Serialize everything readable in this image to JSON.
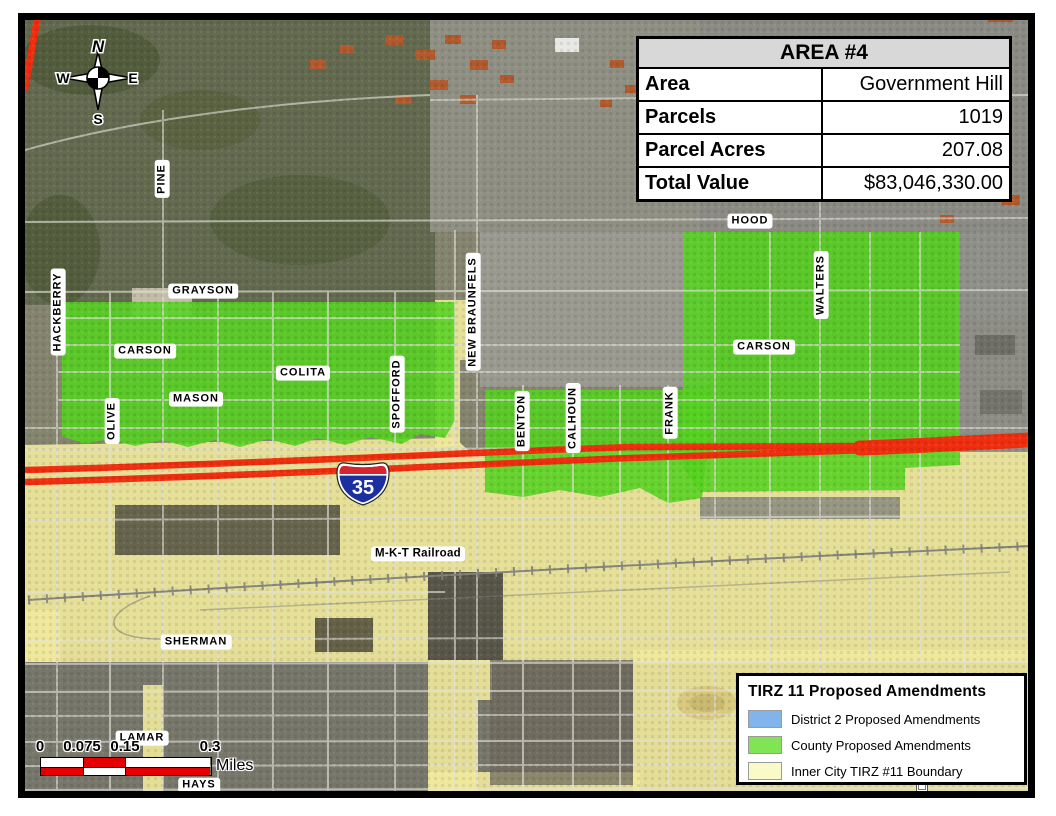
{
  "info_table": {
    "title": "AREA #4",
    "rows": [
      {
        "label": "Area",
        "value": "Government Hill"
      },
      {
        "label": "Parcels",
        "value": "1019"
      },
      {
        "label": "Parcel Acres",
        "value": "207.08"
      },
      {
        "label": "Total Value",
        "value": "$83,046,330.00"
      }
    ]
  },
  "legend": {
    "title": "TIRZ 11 Proposed Amendments",
    "items": [
      {
        "label": "District 2 Proposed Amendments",
        "color": "#82B3EA"
      },
      {
        "label": "County Proposed Amendments",
        "color": "#80E455"
      },
      {
        "label": "Inner City TIRZ #11 Boundary",
        "color": "#FAFAC8"
      }
    ]
  },
  "scale_bar": {
    "ticks": [
      "0",
      "0.075",
      "0.15",
      "0.3"
    ],
    "unit": "Miles"
  },
  "compass": {
    "north": "N",
    "east": "E",
    "south": "S",
    "west": "W"
  },
  "highway_shield": {
    "route": "35"
  },
  "street_labels": [
    {
      "text": "PINE",
      "orientation": "vertical"
    },
    {
      "text": "HACKBERRY",
      "orientation": "vertical"
    },
    {
      "text": "GRAYSON",
      "orientation": "horizontal"
    },
    {
      "text": "CARSON",
      "orientation": "horizontal"
    },
    {
      "text": "OLIVE",
      "orientation": "vertical"
    },
    {
      "text": "MASON",
      "orientation": "horizontal"
    },
    {
      "text": "COLITA",
      "orientation": "horizontal"
    },
    {
      "text": "SPOFFORD",
      "orientation": "vertical"
    },
    {
      "text": "NEW BRAUNFELS",
      "orientation": "vertical"
    },
    {
      "text": "BENTON",
      "orientation": "vertical"
    },
    {
      "text": "CALHOUN",
      "orientation": "vertical"
    },
    {
      "text": "FRANK",
      "orientation": "vertical"
    },
    {
      "text": "HOOD",
      "orientation": "horizontal"
    },
    {
      "text": "WALTERS",
      "orientation": "vertical"
    },
    {
      "text": "CARSON",
      "orientation": "horizontal"
    },
    {
      "text": "M-K-T Railroad",
      "orientation": "horizontal"
    },
    {
      "text": "SHERMAN",
      "orientation": "horizontal"
    },
    {
      "text": "LAMAR",
      "orientation": "horizontal"
    },
    {
      "text": "HAYS",
      "orientation": "horizontal"
    }
  ],
  "map_colors": {
    "county_green": "#55D220",
    "tirz_yellow": "#EFE99C",
    "highway_red": "#EE2E0E"
  }
}
